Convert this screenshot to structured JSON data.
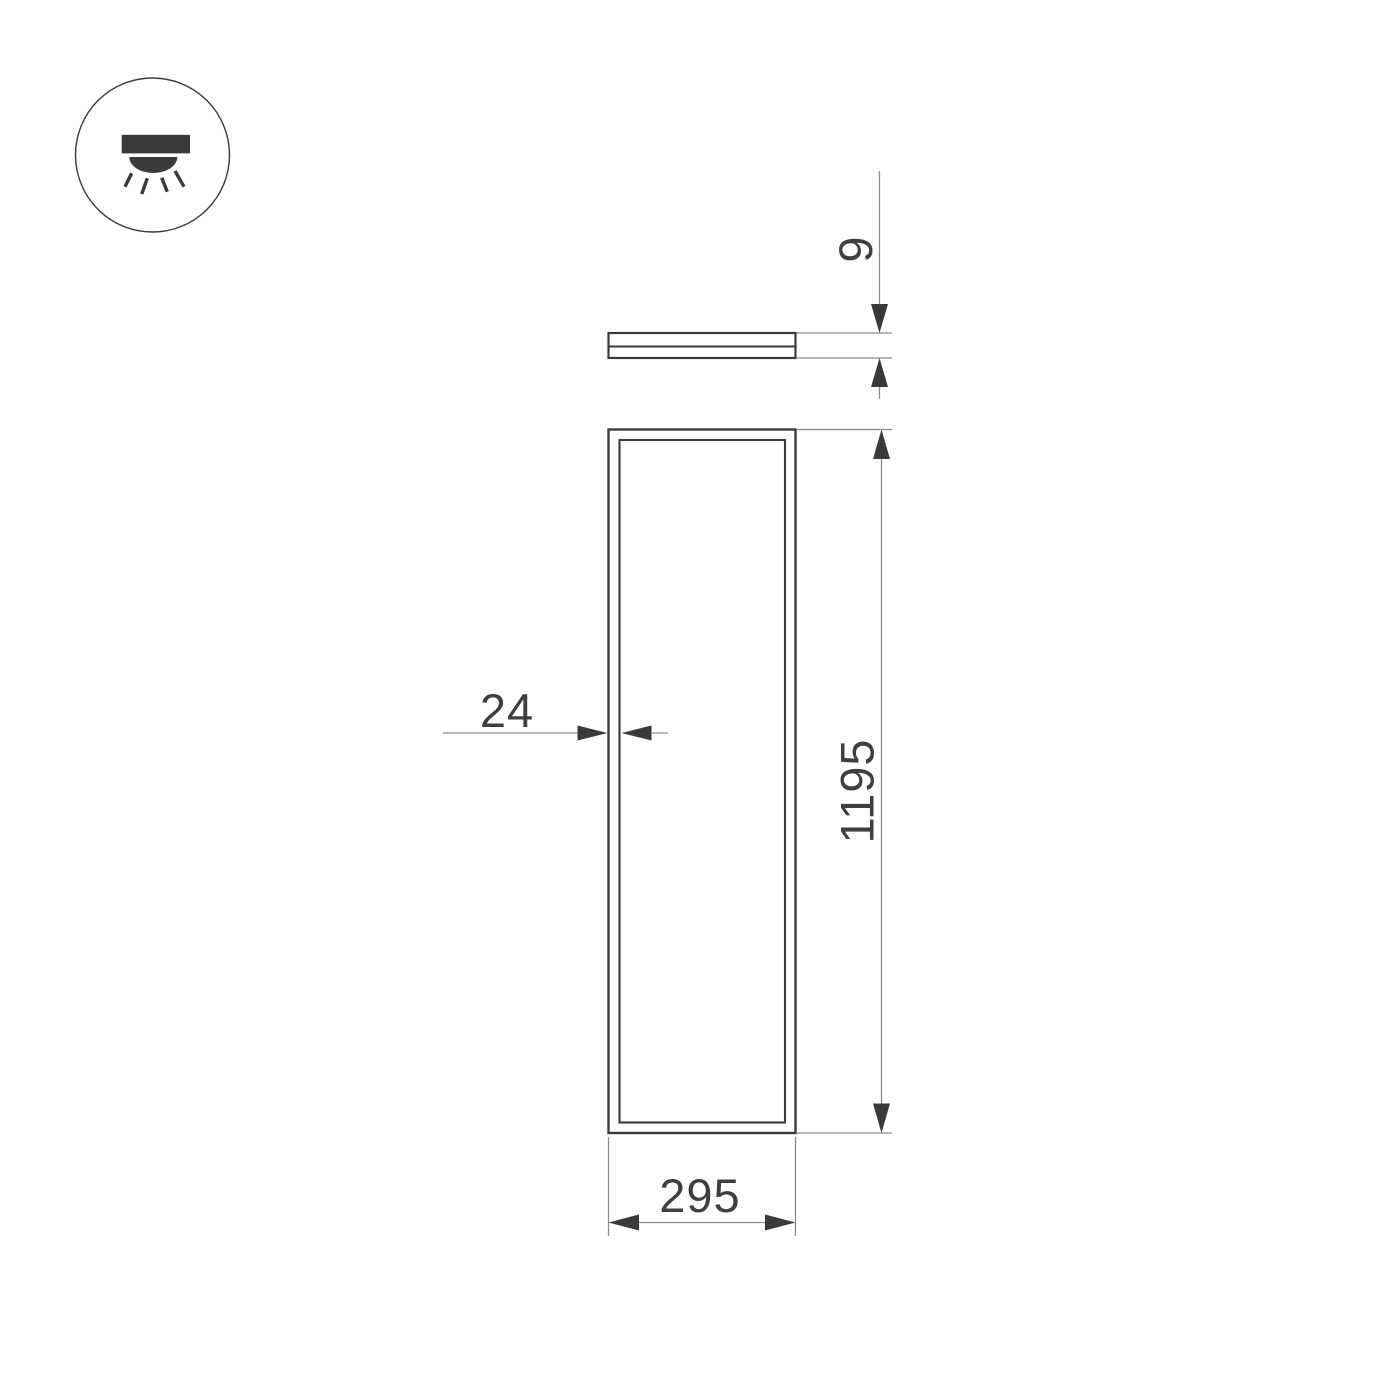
{
  "colors": {
    "line_dark": "#3a3a3a",
    "line_dim": "#8a8a8a",
    "text": "#3f3f3f",
    "background": "#ffffff"
  },
  "icon": {
    "name": "ceiling-downlight-icon"
  },
  "dimensions": {
    "thickness": "9",
    "frame_border": "24",
    "length": "1195",
    "width": "295"
  }
}
